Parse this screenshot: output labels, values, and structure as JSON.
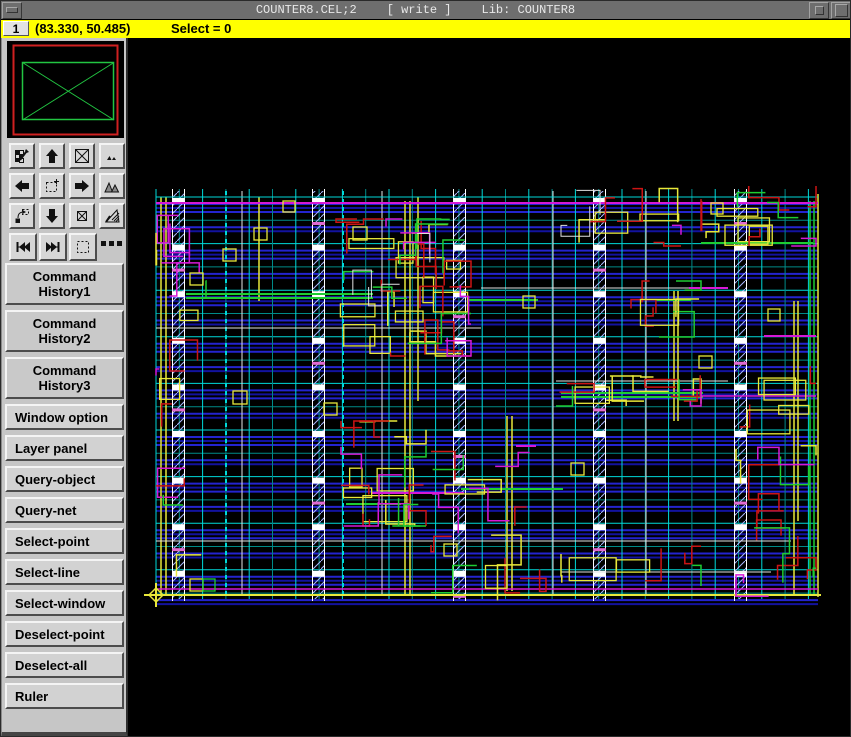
{
  "titlebar": {
    "title": "COUNTER8.CEL;2",
    "write_badge": "[ write ]",
    "library": "Lib: COUNTER8"
  },
  "statusbar": {
    "workspace": "1",
    "coordinates": "(83.330, 50.485)",
    "selection": "Select = 0",
    "bg_color": "#ffff00"
  },
  "sidebar": {
    "tool_icons": [
      {
        "name": "edit-region-button",
        "icon": "checker-pencil"
      },
      {
        "name": "pan-up-button",
        "icon": "arrow-up"
      },
      {
        "name": "zoom-fit-button",
        "icon": "box-x"
      },
      {
        "name": "peak-small-button",
        "icon": "peaks-small"
      },
      {
        "name": "pan-left-button",
        "icon": "arrow-left"
      },
      {
        "name": "zoom-in-window-button",
        "icon": "dotted-plus"
      },
      {
        "name": "pan-right-button",
        "icon": "arrow-right"
      },
      {
        "name": "peak-large-button",
        "icon": "peaks-large"
      },
      {
        "name": "zoom-out-button",
        "icon": "zoom-out"
      },
      {
        "name": "pan-down-button",
        "icon": "arrow-down"
      },
      {
        "name": "zoom-box-button",
        "icon": "box-x-small"
      },
      {
        "name": "hatch-corner-button",
        "icon": "hatch-check"
      },
      {
        "name": "prev-view-button",
        "icon": "prev"
      },
      {
        "name": "next-view-button",
        "icon": "next"
      },
      {
        "name": "select-region-button",
        "icon": "dotted-box"
      },
      {
        "name": "more-options",
        "icon": "dots"
      }
    ],
    "buttons": [
      {
        "label": "Command\nHistory1",
        "tall": true
      },
      {
        "label": "Command\nHistory2",
        "tall": true
      },
      {
        "label": "Command\nHistory3",
        "tall": true
      },
      {
        "label": "Window option",
        "tall": false
      },
      {
        "label": "Layer panel",
        "tall": false
      },
      {
        "label": "Query-object",
        "tall": false
      },
      {
        "label": "Query-net",
        "tall": false
      },
      {
        "label": "Select-point",
        "tall": false
      },
      {
        "label": "Select-line",
        "tall": false
      },
      {
        "label": "Select-window",
        "tall": false
      },
      {
        "label": "Deselect-point",
        "tall": false
      },
      {
        "label": "Deselect-all",
        "tall": false
      },
      {
        "label": "Ruler",
        "tall": false
      }
    ]
  },
  "overview": {
    "border_color": "#cf2020",
    "viewport_color": "#22c542"
  },
  "layout": {
    "bounds": {
      "x0": 155,
      "y0": 196,
      "x1": 817,
      "y1": 593
    },
    "cell": 23.3,
    "colors": {
      "tealBright": "#00d9d9",
      "tealDim": "#008a88",
      "blue1": "#2424cf",
      "blue2": "#12129e",
      "Y": "#e8e83a",
      "R": "#cc1414",
      "G": "#1ecc32",
      "M": "#d619d6",
      "W": "#e2e2e2",
      "C": "#00d9d9"
    },
    "strips": {
      "x": [
        171,
        311,
        452,
        592,
        733
      ],
      "width": 13
    },
    "white_verticals": [
      241,
      381,
      552,
      645
    ],
    "dashed_verticals": [
      225,
      342
    ],
    "yellow_verticals": [
      [
        160,
        196,
        593
      ],
      [
        165,
        196,
        593
      ],
      [
        258,
        196,
        300
      ],
      [
        404,
        200,
        593
      ],
      [
        409,
        200,
        593
      ],
      [
        417,
        196,
        400
      ],
      [
        506,
        415,
        590
      ],
      [
        511,
        415,
        590
      ],
      [
        673,
        290,
        420
      ],
      [
        677,
        290,
        420
      ],
      [
        793,
        300,
        593
      ],
      [
        797,
        300,
        520
      ],
      [
        817,
        193,
        596
      ]
    ],
    "green_verticals": [
      [
        809,
        200,
        593
      ],
      [
        813,
        200,
        593
      ]
    ],
    "special_lines": [
      [
        "M",
        155,
        202,
        817,
        2
      ],
      [
        "M",
        155,
        588,
        817,
        1.5
      ],
      [
        "Y",
        150,
        594,
        820,
        2
      ],
      [
        "C",
        155,
        196,
        817,
        1
      ],
      [
        "W",
        155,
        327,
        480,
        1
      ],
      [
        "W",
        480,
        287,
        727,
        1
      ],
      [
        "W",
        555,
        380,
        727,
        1
      ],
      [
        "W",
        560,
        571,
        770,
        1
      ],
      [
        "W",
        155,
        540,
        790,
        1
      ],
      [
        "G",
        185,
        293,
        372,
        2
      ],
      [
        "G",
        185,
        297,
        372,
        2
      ],
      [
        "G",
        467,
        299,
        537,
        2
      ],
      [
        "G",
        655,
        299,
        690,
        2
      ],
      [
        "G",
        560,
        392,
        702,
        2
      ],
      [
        "G",
        560,
        396,
        702,
        2
      ],
      [
        "G",
        460,
        488,
        562,
        2
      ],
      [
        "G",
        700,
        242,
        812,
        2
      ],
      [
        "G",
        345,
        503,
        400,
        2
      ],
      [
        "M",
        515,
        445,
        535,
        2
      ],
      [
        "M",
        688,
        287,
        727,
        2
      ],
      [
        "M",
        370,
        492,
        463,
        2
      ],
      [
        "M",
        763,
        335,
        815,
        2
      ],
      [
        "M",
        700,
        395,
        815,
        1.5
      ]
    ],
    "boxes": [
      [
        253,
        227,
        13,
        12,
        "Y"
      ],
      [
        222,
        248,
        13,
        12,
        "Y"
      ],
      [
        189,
        272,
        13,
        12,
        "Y"
      ],
      [
        352,
        226,
        14,
        13,
        "Y"
      ],
      [
        522,
        295,
        12,
        12,
        "Y"
      ],
      [
        710,
        202,
        12,
        11,
        "Y"
      ],
      [
        767,
        308,
        12,
        12,
        "Y"
      ],
      [
        232,
        390,
        14,
        13,
        "Y"
      ],
      [
        323,
        402,
        13,
        12,
        "Y"
      ],
      [
        189,
        578,
        13,
        12,
        "Y"
      ],
      [
        570,
        462,
        13,
        12,
        "Y"
      ],
      [
        698,
        355,
        13,
        12,
        "Y"
      ],
      [
        443,
        543,
        13,
        12,
        "Y"
      ],
      [
        282,
        200,
        12,
        11,
        "Y"
      ],
      [
        202,
        578,
        12,
        12,
        "G"
      ]
    ],
    "clusters": [
      {
        "b": [
          335,
          218,
          470,
          355
        ],
        "n": {
          "Y": 14,
          "R": 12,
          "G": 6,
          "M": 5,
          "W": 3
        }
      },
      {
        "b": [
          340,
          420,
          425,
          525
        ],
        "n": {
          "Y": 7,
          "R": 6,
          "M": 3,
          "G": 3
        }
      },
      {
        "b": [
          555,
          375,
          700,
          405
        ],
        "n": {
          "Y": 6,
          "R": 4,
          "G": 2,
          "M": 1
        }
      },
      {
        "b": [
          700,
          185,
          815,
          245
        ],
        "n": {
          "Y": 5,
          "R": 4,
          "G": 2,
          "M": 1
        }
      },
      {
        "b": [
          560,
          185,
          680,
          245
        ],
        "n": {
          "Y": 4,
          "R": 3,
          "W": 2,
          "M": 1
        }
      },
      {
        "b": [
          735,
          320,
          815,
          600
        ],
        "n": {
          "R": 8,
          "Y": 6,
          "G": 3,
          "M": 2
        }
      },
      {
        "b": [
          430,
          430,
          545,
          600
        ],
        "n": {
          "R": 5,
          "Y": 4,
          "M": 3,
          "G": 2
        }
      },
      {
        "b": [
          155,
          200,
          205,
          590
        ],
        "n": {
          "M": 6,
          "Y": 4,
          "R": 3,
          "G": 2
        }
      },
      {
        "b": [
          560,
          540,
          700,
          585
        ],
        "n": {
          "Y": 3,
          "R": 2,
          "G": 1
        }
      },
      {
        "b": [
          630,
          280,
          700,
          340
        ],
        "n": {
          "R": 3,
          "G": 2,
          "Y": 2
        }
      }
    ],
    "crosshair": {
      "x": 155,
      "y": 594
    },
    "seed": 7
  }
}
